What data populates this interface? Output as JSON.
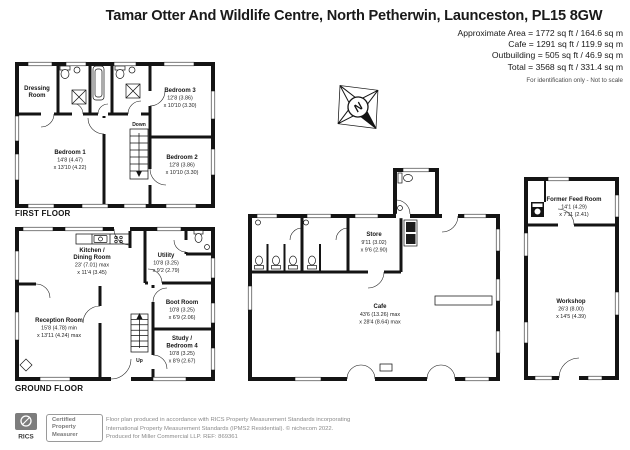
{
  "header": {
    "title": "Tamar Otter And Wildlife Centre, North Petherwin, Launceston, PL15 8GW",
    "area_lines": [
      "Approximate Area = 1772 sq ft / 164.6 sq m",
      "Cafe = 1291 sq ft / 119.9 sq m",
      "Outbuilding = 505 sq ft / 46.9 sq m",
      "Total = 3568 sq ft / 331.4 sq m"
    ],
    "note": "For identification only - Not to scale"
  },
  "compass": {
    "north": "N"
  },
  "floors": {
    "first": {
      "caption": "FIRST FLOOR",
      "dressing": {
        "l1": "Dressing",
        "l2": "Room"
      },
      "bedroom1": {
        "name": "Bedroom 1",
        "d1": "14'8 (4.47)",
        "d2": "x 13'10 (4.22)"
      },
      "bedroom2": {
        "name": "Bedroom 2",
        "d1": "12'8 (3.86)",
        "d2": "x 10'10 (3.30)"
      },
      "bedroom3": {
        "name": "Bedroom 3",
        "d1": "12'8 (3.86)",
        "d2": "x 10'10 (3.30)"
      },
      "stairs": "Down"
    },
    "ground": {
      "caption": "GROUND FLOOR",
      "kitchen": {
        "l1": "Kitchen /",
        "l2": "Dining Room",
        "d1": "23' (7.01) max",
        "d2": "x 11'4 (3.45)"
      },
      "utility": {
        "name": "Utility",
        "d1": "10'8 (3.25)",
        "d2": "x 9'2 (2.79)"
      },
      "reception": {
        "name": "Reception Room",
        "d1": "15'8 (4.78) min",
        "d2": "x 13'11 (4.24) max"
      },
      "boot": {
        "name": "Boot Room",
        "d1": "10'8 (3.25)",
        "d2": "x 6'9 (2.06)"
      },
      "study": {
        "l1": "Study /",
        "l2": "Bedroom 4",
        "d1": "10'8 (3.25)",
        "d2": "x 8'9 (2.67)"
      },
      "stairs": "Up"
    },
    "cafe": {
      "store": {
        "name": "Store",
        "d1": "9'11 (3.02)",
        "d2": "x 9'6 (2.90)"
      },
      "cafe": {
        "name": "Cafe",
        "d1": "43'6 (13.26) max",
        "d2": "x 28'4 (8.64) max"
      }
    },
    "outbuilding": {
      "feed_room": {
        "name": "Former Feed Room",
        "d1": "14'1 (4.29)",
        "d2": "x 7'11 (2.41)"
      },
      "workshop": {
        "name": "Workshop",
        "d1": "26'3 (8.00)",
        "d2": "x 14'5 (4.39)"
      }
    }
  },
  "footer": {
    "rics": "RICS",
    "badge": {
      "l1": "Certified",
      "l2": "Property",
      "l3": "Measurer"
    },
    "line1": "Floor plan produced in accordance with RICS Property Measurement Standards incorporating",
    "line2": "International Property Measurement Standards (IPMS2 Residential).  © nichecom 2022.",
    "line3": "Produced for Miller Commercial LLP.   REF: 869361"
  },
  "colors": {
    "wall": "#141414",
    "text": "#1a1a1a",
    "muted": "#8a8a8a"
  }
}
